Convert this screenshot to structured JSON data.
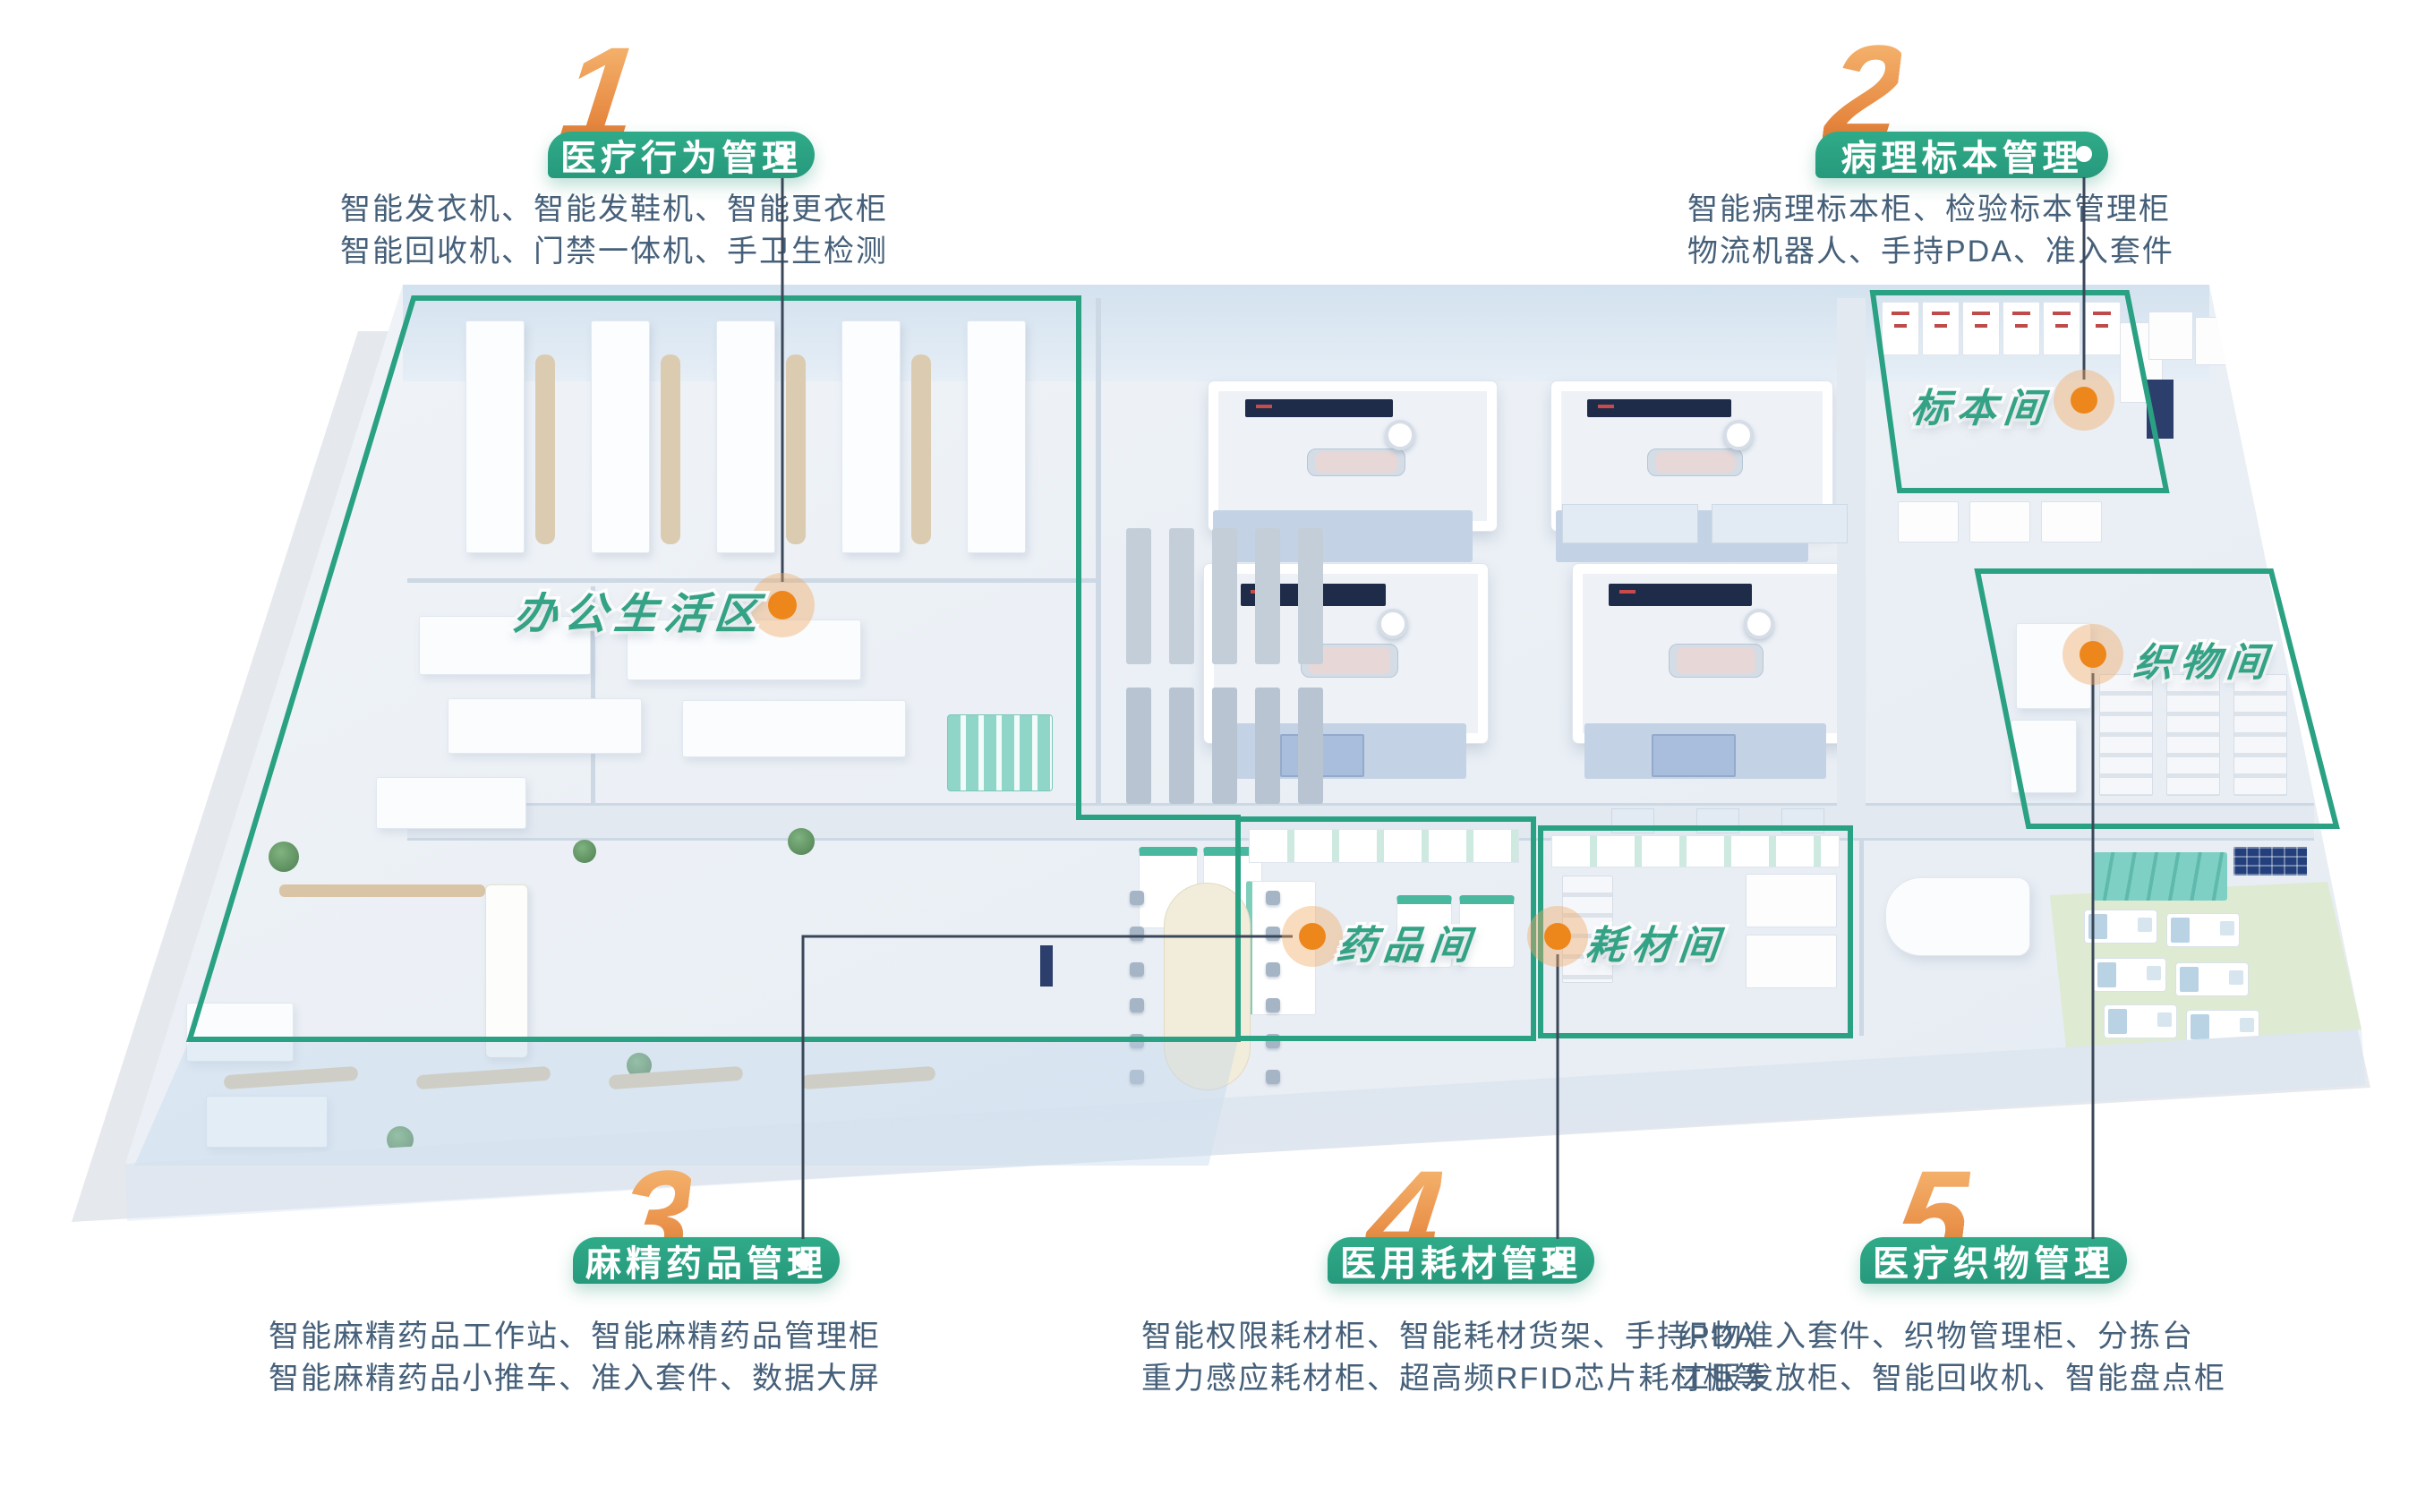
{
  "poster": {
    "sections": [
      {
        "num": "1",
        "title": "医疗行为管理",
        "items": [
          "智能发衣机、智能发鞋机、智能更衣柜",
          "智能回收机、门禁一体机、手卫生检测"
        ]
      },
      {
        "num": "2",
        "title": "病理标本管理",
        "items": [
          "智能病理标本柜、检验标本管理柜",
          "物流机器人、手持PDA、准入套件"
        ]
      },
      {
        "num": "3",
        "title": "麻精药品管理",
        "items": [
          "智能麻精药品工作站、智能麻精药品管理柜",
          "智能麻精药品小推车、准入套件、数据大屏"
        ]
      },
      {
        "num": "4",
        "title": "医用耗材管理",
        "items": [
          "智能权限耗材柜、智能耗材货架、手持PDA",
          "重力感应耗材柜、超高频RFID芯片耗材柜等"
        ]
      },
      {
        "num": "5",
        "title": "医疗织物管理",
        "items": [
          "织物准入套件、织物管理柜、分拣台",
          "工服发放柜、智能回收机、智能盘点柜"
        ]
      }
    ],
    "rooms": [
      {
        "name": "办公生活区"
      },
      {
        "name": "标本间"
      },
      {
        "name": "织物间"
      },
      {
        "name": "药品间"
      },
      {
        "name": "耗材间"
      }
    ],
    "colors": {
      "zone_green": "#2aa183",
      "marker_orange": "#ee871b",
      "number_orange": "#e88a3c",
      "desc_text": "#46607a",
      "leader_line": "#3a4759",
      "room_text_green": "#33a285"
    }
  }
}
